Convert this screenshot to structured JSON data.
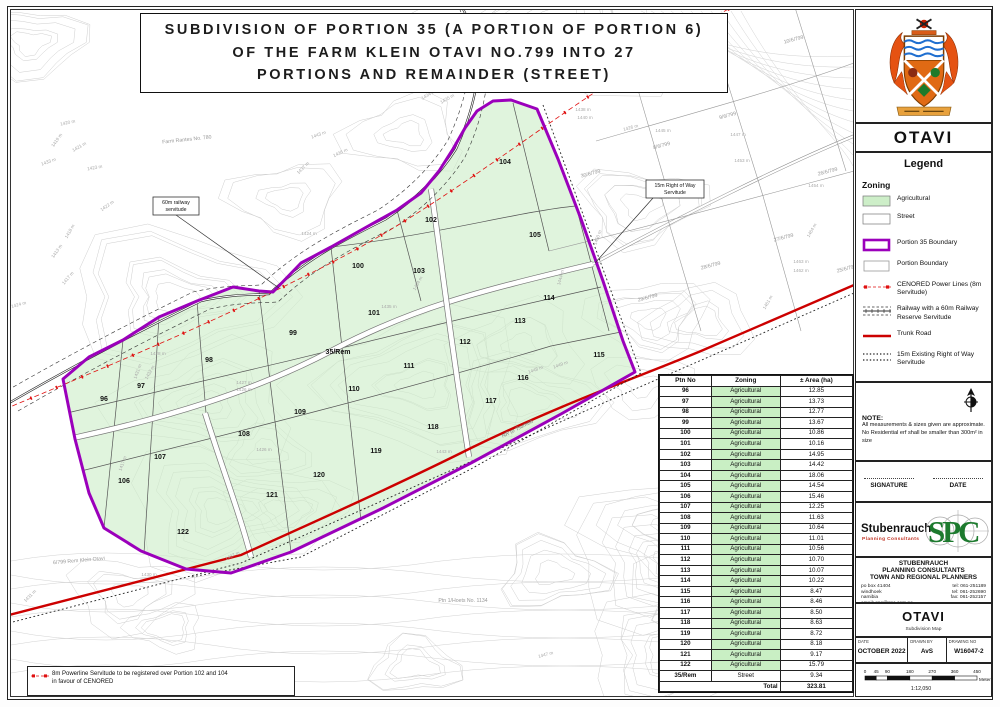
{
  "title": {
    "line1": "SUBDIVISION OF PORTION 35 (A PORTION OF PORTION 6)",
    "line2": "OF THE FARM KLEIN OTAVI NO.799 INTO 27",
    "line3": "PORTIONS AND REMAINDER (STREET)"
  },
  "colors": {
    "agri_green": "#cdeec8",
    "boundary_purple": "#9b00bb",
    "power_red": "#e01010",
    "trunk_red": "#cc0000",
    "table_green": "#c9efc4",
    "spc_green": "#1d7a2e"
  },
  "panel": {
    "town": "OTAVI",
    "legend_title": "Legend",
    "zoning_title": "Zoning",
    "zoning_items": [
      {
        "type": "swatch-agri",
        "label": "Agricultural"
      },
      {
        "type": "swatch-street",
        "label": "Street"
      }
    ],
    "legend_items": [
      {
        "type": "purple-box",
        "label": "Portion 35 Boundary"
      },
      {
        "type": "white-box",
        "label": "Portion Boundary"
      },
      {
        "type": "power-line",
        "label": "CENORED Power Lines (8m Servitude)"
      },
      {
        "type": "railway",
        "label": "Railway with a 60m Railway Reserve Servitude"
      },
      {
        "type": "trunk-road",
        "label": "Trunk Road"
      },
      {
        "type": "dotted",
        "label": "15m Existing Right of Way Servitude"
      }
    ],
    "note_title": "NOTE:",
    "note_lines": [
      "All measurements & sizes given are approximate.",
      "No Residential erf shall be smaller than 300m² in size"
    ],
    "signature_label": "SIGNATURE",
    "date_label": "DATE",
    "logo": {
      "name": "Stubenrauch",
      "sub": "Planning Consultants",
      "monogram": "SPC"
    },
    "firm": {
      "lines": [
        "STUBENRAUCH",
        "PLANNING CONSULTANTS",
        "TOWN AND REGIONAL PLANNERS"
      ],
      "address": [
        "po box 41404",
        "windhoek",
        "namibia",
        "email: spc@spc.com.na"
      ],
      "phones": [
        "tel: 061-251189",
        "tel: 061-252690",
        "fax: 061-252157"
      ]
    },
    "project": {
      "name": "OTAVI",
      "subtitle": "Subdivision Map"
    },
    "titleblock": {
      "date_label": "DATE",
      "date": "OCTOBER 2022",
      "drawn_label": "DRAWN BY",
      "drawn": "AvS",
      "drawing_label": "DRAWING NO",
      "drawing": "W16047-2"
    },
    "scale": {
      "ticks": [
        0,
        45,
        90,
        180,
        270,
        360,
        450
      ],
      "unit": "Meters",
      "ratio": "1:12,050"
    }
  },
  "table": {
    "headers": [
      "Ptn No",
      "Zoning",
      "± Area (ha)"
    ],
    "rows": [
      [
        "96",
        "Agricultural",
        "12.85"
      ],
      [
        "97",
        "Agricultural",
        "13.73"
      ],
      [
        "98",
        "Agricultural",
        "12.77"
      ],
      [
        "99",
        "Agricultural",
        "13.67"
      ],
      [
        "100",
        "Agricultural",
        "10.86"
      ],
      [
        "101",
        "Agricultural",
        "10.16"
      ],
      [
        "102",
        "Agricultural",
        "14.95"
      ],
      [
        "103",
        "Agricultural",
        "14.42"
      ],
      [
        "104",
        "Agricultural",
        "18.06"
      ],
      [
        "105",
        "Agricultural",
        "14.54"
      ],
      [
        "106",
        "Agricultural",
        "15.46"
      ],
      [
        "107",
        "Agricultural",
        "12.25"
      ],
      [
        "108",
        "Agricultural",
        "11.63"
      ],
      [
        "109",
        "Agricultural",
        "10.64"
      ],
      [
        "110",
        "Agricultural",
        "11.01"
      ],
      [
        "111",
        "Agricultural",
        "10.56"
      ],
      [
        "112",
        "Agricultural",
        "10.70"
      ],
      [
        "113",
        "Agricultural",
        "10.07"
      ],
      [
        "114",
        "Agricultural",
        "10.22"
      ],
      [
        "115",
        "Agricultural",
        "8.47"
      ],
      [
        "116",
        "Agricultural",
        "8.46"
      ],
      [
        "117",
        "Agricultural",
        "8.50"
      ],
      [
        "118",
        "Agricultural",
        "8.63"
      ],
      [
        "119",
        "Agricultural",
        "8.72"
      ],
      [
        "120",
        "Agricultural",
        "8.18"
      ],
      [
        "121",
        "Agricultural",
        "9.17"
      ],
      [
        "122",
        "Agricultural",
        "15.79"
      ],
      [
        "35/Rem",
        "Street",
        "9.34"
      ]
    ],
    "total_label": "Total",
    "total": "323.81"
  },
  "map": {
    "portions": [
      {
        "no": "96",
        "x": 103,
        "y": 400
      },
      {
        "no": "97",
        "x": 140,
        "y": 387
      },
      {
        "no": "98",
        "x": 208,
        "y": 361
      },
      {
        "no": "99",
        "x": 292,
        "y": 334
      },
      {
        "no": "100",
        "x": 357,
        "y": 267
      },
      {
        "no": "101",
        "x": 373,
        "y": 314
      },
      {
        "no": "102",
        "x": 430,
        "y": 221
      },
      {
        "no": "103",
        "x": 418,
        "y": 272
      },
      {
        "no": "104",
        "x": 504,
        "y": 163
      },
      {
        "no": "105",
        "x": 534,
        "y": 236
      },
      {
        "no": "106",
        "x": 123,
        "y": 482
      },
      {
        "no": "107",
        "x": 159,
        "y": 458
      },
      {
        "no": "108",
        "x": 243,
        "y": 435
      },
      {
        "no": "109",
        "x": 299,
        "y": 413
      },
      {
        "no": "110",
        "x": 353,
        "y": 390
      },
      {
        "no": "111",
        "x": 408,
        "y": 367
      },
      {
        "no": "112",
        "x": 464,
        "y": 343
      },
      {
        "no": "113",
        "x": 519,
        "y": 322
      },
      {
        "no": "114",
        "x": 548,
        "y": 299
      },
      {
        "no": "115",
        "x": 598,
        "y": 356
      },
      {
        "no": "116",
        "x": 522,
        "y": 379
      },
      {
        "no": "117",
        "x": 490,
        "y": 402
      },
      {
        "no": "118",
        "x": 432,
        "y": 428
      },
      {
        "no": "119",
        "x": 375,
        "y": 452
      },
      {
        "no": "120",
        "x": 318,
        "y": 476
      },
      {
        "no": "121",
        "x": 271,
        "y": 496
      },
      {
        "no": "122",
        "x": 182,
        "y": 533
      },
      {
        "no": "35/Rem",
        "x": 337,
        "y": 353
      }
    ],
    "farm_labels": [
      {
        "t": "Farm Rantes No. 780",
        "x": 186,
        "y": 140,
        "r": -6
      },
      {
        "t": "6/799 Rem Klein Otavi",
        "x": 78,
        "y": 561,
        "r": -5
      },
      {
        "t": "Ptn 1/Hoets No. 1134",
        "x": 462,
        "y": 601,
        "r": 0
      },
      {
        "t": "9/6/799",
        "x": 727,
        "y": 116,
        "r": -15
      },
      {
        "t": "8/6/799",
        "x": 661,
        "y": 146,
        "r": -15
      },
      {
        "t": "30/6/799",
        "x": 590,
        "y": 174,
        "r": -15
      },
      {
        "t": "26/6/799",
        "x": 827,
        "y": 172,
        "r": -15
      },
      {
        "t": "27/6/799",
        "x": 783,
        "y": 238,
        "r": -15
      },
      {
        "t": "28/6/799",
        "x": 710,
        "y": 266,
        "r": -15
      },
      {
        "t": "29/6/799",
        "x": 647,
        "y": 298,
        "r": -15
      },
      {
        "t": "25/6/799",
        "x": 846,
        "y": 269,
        "r": -15
      },
      {
        "t": "10/6/799",
        "x": 793,
        "y": 40,
        "r": -15
      }
    ],
    "contour_labels": [
      {
        "t": "1420 m",
        "x": 67,
        "y": 123,
        "r": -12
      },
      {
        "t": "1419 m",
        "x": 57,
        "y": 140,
        "r": -55
      },
      {
        "t": "1421 m",
        "x": 79,
        "y": 147,
        "r": -30
      },
      {
        "t": "1423 m",
        "x": 94,
        "y": 168,
        "r": -10
      },
      {
        "t": "1422 m",
        "x": 107,
        "y": 206,
        "r": -35
      },
      {
        "t": "1418 m",
        "x": 70,
        "y": 231,
        "r": -60
      },
      {
        "t": "1413 m",
        "x": 57,
        "y": 251,
        "r": -55
      },
      {
        "t": "1417 m",
        "x": 68,
        "y": 278,
        "r": -50
      },
      {
        "t": "1433 m",
        "x": 48,
        "y": 162,
        "r": -20
      },
      {
        "t": "1424 m",
        "x": 308,
        "y": 234,
        "r": 0
      },
      {
        "t": "1437 m",
        "x": 303,
        "y": 168,
        "r": -45
      },
      {
        "t": "1438 m",
        "x": 582,
        "y": 110,
        "r": 0
      },
      {
        "t": "1440 m",
        "x": 584,
        "y": 118,
        "r": 0
      },
      {
        "t": "1443 m",
        "x": 318,
        "y": 135,
        "r": -20
      },
      {
        "t": "1436 m",
        "x": 340,
        "y": 153,
        "r": -25
      },
      {
        "t": "1434 m",
        "x": 428,
        "y": 95,
        "r": -30
      },
      {
        "t": "1435 m",
        "x": 447,
        "y": 99,
        "r": -30
      },
      {
        "t": "1428 m",
        "x": 157,
        "y": 354,
        "r": 0
      },
      {
        "t": "1431 m",
        "x": 138,
        "y": 371,
        "r": -70
      },
      {
        "t": "1432 m",
        "x": 150,
        "y": 372,
        "r": -60
      },
      {
        "t": "1427 m",
        "x": 243,
        "y": 383,
        "r": 0
      },
      {
        "t": "1426 m",
        "x": 243,
        "y": 390,
        "r": 0
      },
      {
        "t": "1434 m",
        "x": 418,
        "y": 283,
        "r": -60
      },
      {
        "t": "1435 m",
        "x": 388,
        "y": 307,
        "r": 0
      },
      {
        "t": "1426 m",
        "x": 263,
        "y": 450,
        "r": 0
      },
      {
        "t": "1417 m",
        "x": 123,
        "y": 463,
        "r": -70
      },
      {
        "t": "1445 m",
        "x": 662,
        "y": 131,
        "r": 0
      },
      {
        "t": "1447 m",
        "x": 737,
        "y": 135,
        "r": 0
      },
      {
        "t": "1453 m",
        "x": 741,
        "y": 161,
        "r": 0
      },
      {
        "t": "1454 m",
        "x": 815,
        "y": 186,
        "r": 0
      },
      {
        "t": "1463 m",
        "x": 800,
        "y": 262,
        "r": 0
      },
      {
        "t": "1462 m",
        "x": 800,
        "y": 271,
        "r": 0
      },
      {
        "t": "1461 m",
        "x": 768,
        "y": 302,
        "r": -60
      },
      {
        "t": "1464 m",
        "x": 812,
        "y": 230,
        "r": -60
      },
      {
        "t": "1450 m",
        "x": 598,
        "y": 237,
        "r": -70
      },
      {
        "t": "1444 m",
        "x": 561,
        "y": 277,
        "r": -75
      },
      {
        "t": "1448 m",
        "x": 535,
        "y": 370,
        "r": -20
      },
      {
        "t": "1449 m",
        "x": 560,
        "y": 365,
        "r": -20
      },
      {
        "t": "1430 m",
        "x": 148,
        "y": 575,
        "r": 0
      },
      {
        "t": "1431 m",
        "x": 30,
        "y": 596,
        "r": -45
      },
      {
        "t": "1437 m",
        "x": 232,
        "y": 556,
        "r": -25
      },
      {
        "t": "1443 m",
        "x": 443,
        "y": 452,
        "r": 0
      },
      {
        "t": "1447 m",
        "x": 545,
        "y": 655,
        "r": -15
      },
      {
        "t": "1424 m",
        "x": 18,
        "y": 305,
        "r": -15
      },
      {
        "t": "1426 m",
        "x": 630,
        "y": 128,
        "r": -15
      }
    ],
    "callouts": [
      {
        "lines": [
          "60m railway",
          "servitude"
        ],
        "x": 152,
        "y": 196,
        "w": 46,
        "h": 18,
        "lx1": 175,
        "ly1": 214,
        "lx2": 278,
        "ly2": 287
      },
      {
        "lines": [
          "15m Right of Way",
          "Servitude"
        ],
        "x": 645,
        "y": 179,
        "w": 58,
        "h": 18,
        "lx1": 652,
        "ly1": 197,
        "lx2": 594,
        "ly2": 262
      }
    ],
    "road_label": {
      "t": "NR to Tsumeb",
      "x": 517,
      "y": 429,
      "r": -27
    },
    "note_box_lines": [
      "8m Powerline Servitude to be registered over Portion 102 and 104",
      "in favour of CENORED"
    ]
  }
}
